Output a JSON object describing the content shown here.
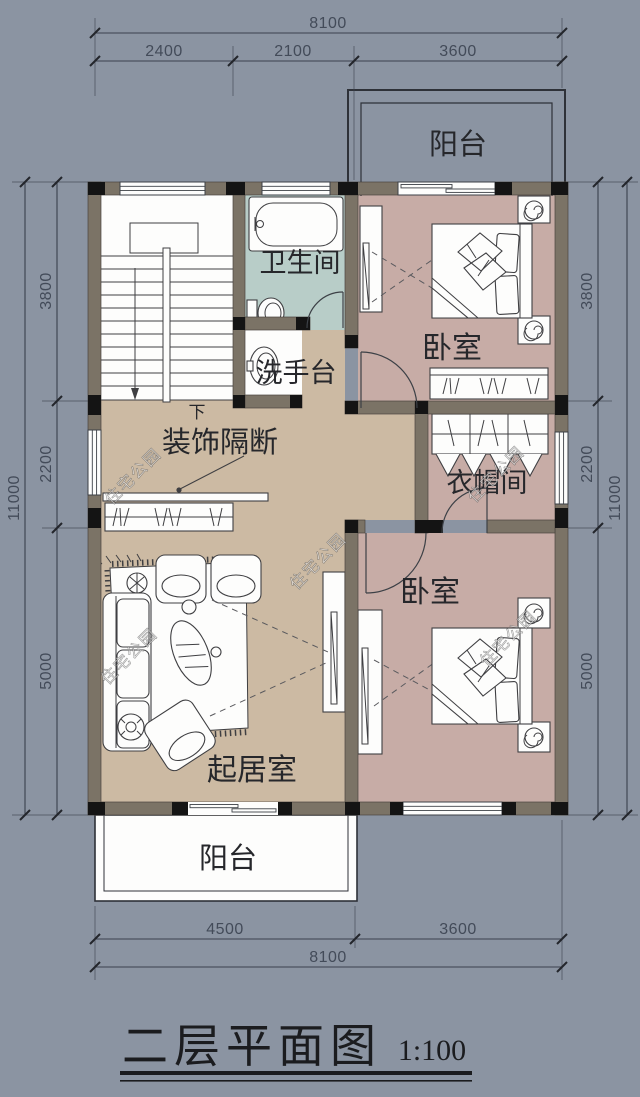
{
  "title": {
    "text": "二层平面图",
    "scale": "1:100"
  },
  "watermark_text": "住宅公园",
  "rooms": {
    "balcony_top": "阳台",
    "bathroom": "卫生间",
    "bedroom_top": "卧室",
    "washstand": "洗手台",
    "partition": "装饰隔断",
    "closet": "衣帽间",
    "bedroom_bottom": "卧室",
    "living": "起居室",
    "balcony_bottom": "阳台",
    "stairs_down": "下"
  },
  "dimensions": {
    "top": {
      "total": "8100",
      "seg1": "2400",
      "seg2": "2100",
      "seg3": "3600"
    },
    "bottom": {
      "seg1": "4500",
      "seg2": "3600",
      "total": "8100"
    },
    "left": {
      "total": "11000",
      "seg1": "3800",
      "seg2": "2200",
      "seg3": "5000"
    },
    "right": {
      "total": "11000",
      "seg1": "3800",
      "seg2": "2200",
      "seg3": "5000"
    }
  },
  "colors": {
    "background": "#8b94a2",
    "wall": "#7b7366",
    "wall_column": "#141414",
    "floor_hall": "#ccbaa3",
    "floor_bedroom": "#c7aca6",
    "floor_bathroom": "#b8cdc8",
    "paper_white": "#fdfdfc",
    "dim_text": "#434b59"
  }
}
